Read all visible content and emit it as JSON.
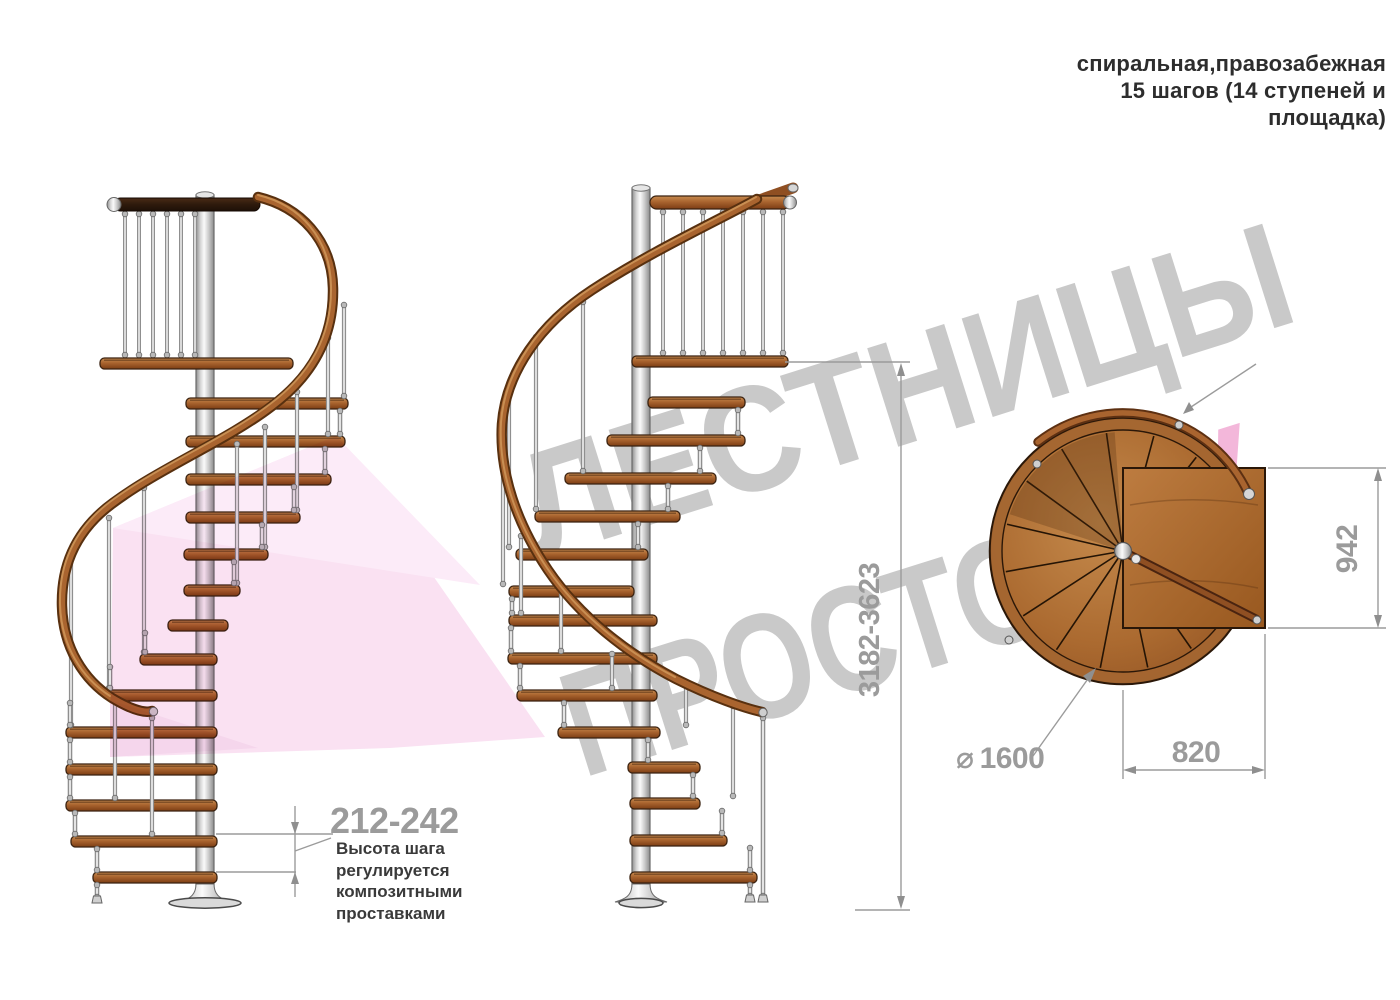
{
  "header": {
    "line1": "спиральная,правозабежная",
    "line2": "15 шагов (14 ступеней и",
    "line3": "площадка)"
  },
  "watermark": {
    "word1": "ЛЕСТНИЦЫ",
    "word2": "ПРОСТО",
    "suffix": ".ру"
  },
  "dimensions": {
    "total_height": "3182-3623",
    "step_height": "212-242",
    "step_note": "Высота шага\nрегулируется\nкомпозитными\nпроставками",
    "plan_depth": "942",
    "plan_width": "820",
    "diameter_symbol": "⌀",
    "diameter_value": "1600"
  },
  "colors": {
    "wood": "#a9642f",
    "wood_dark": "#7c3d14",
    "handrail_dark": "#58300f",
    "metal": "#d9d9d9",
    "watermark_gray": "#c9c9c9",
    "watermark_pink": "#f3b7da",
    "dimension_gray": "#9b9b9b",
    "text_dark": "#2d2d2d"
  }
}
